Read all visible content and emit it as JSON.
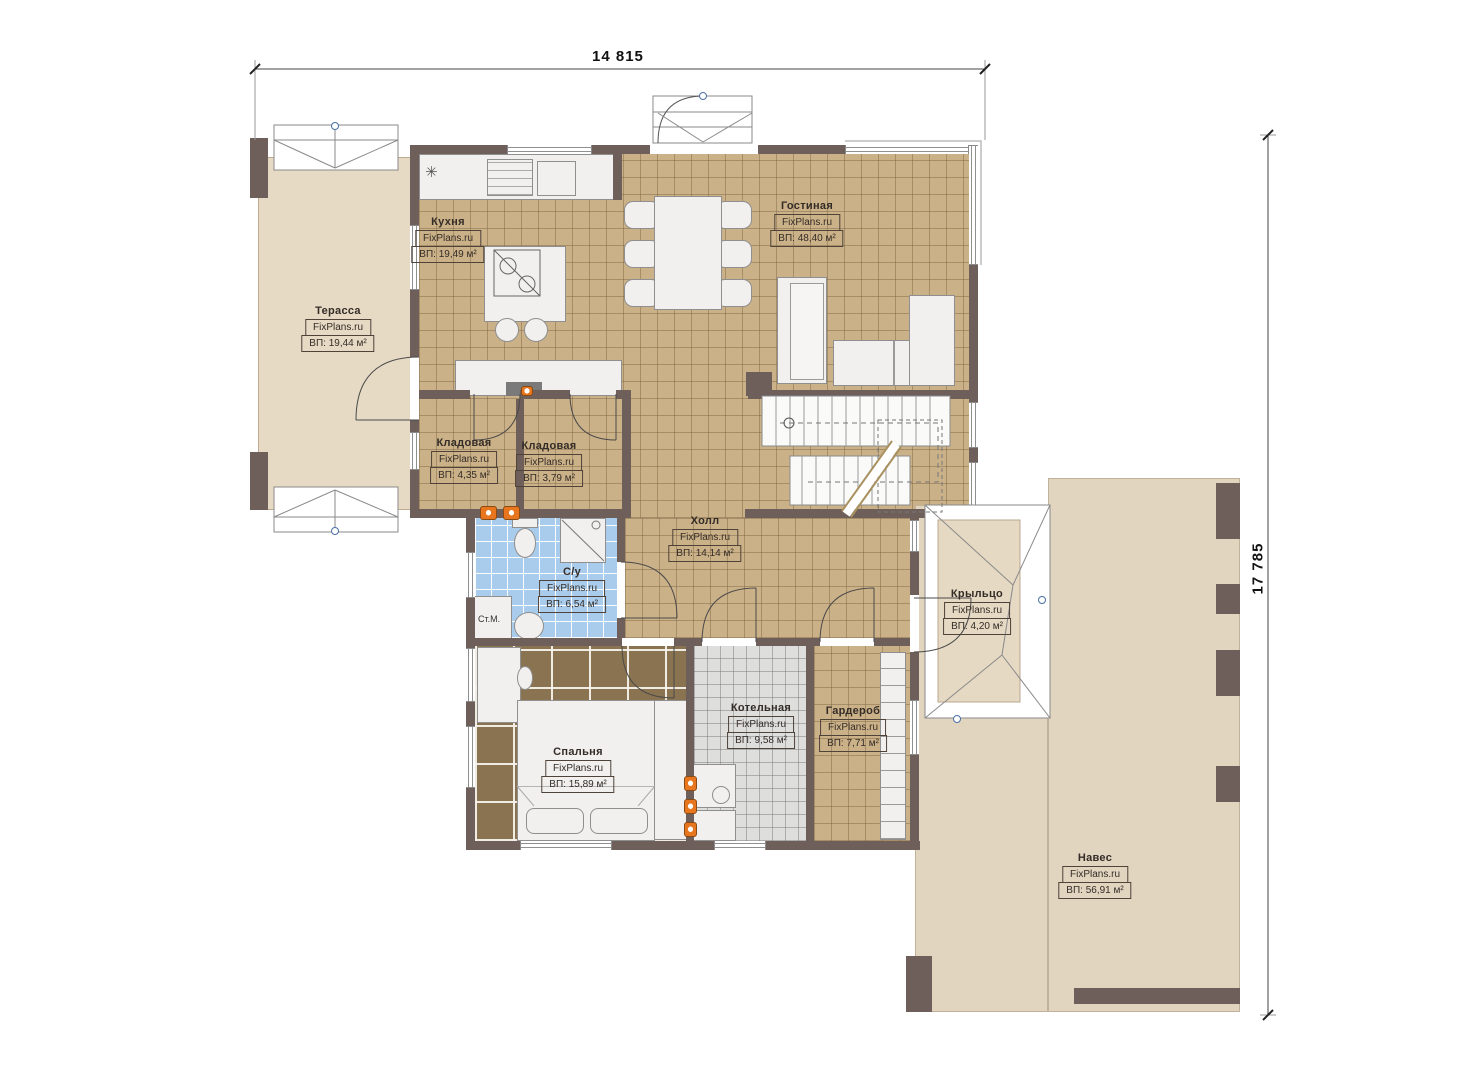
{
  "dimensions": {
    "width_label": "14 815",
    "height_label": "17 785"
  },
  "rooms": [
    {
      "id": "terrace",
      "name": "Терасса",
      "brand": "FixPlans.ru",
      "area": "ВП: 19,44 м²"
    },
    {
      "id": "kitchen",
      "name": "Кухня",
      "brand": "FixPlans.ru",
      "area": "ВП: 19,49 м²"
    },
    {
      "id": "living",
      "name": "Гостиная",
      "brand": "FixPlans.ru",
      "area": "ВП: 48,40 м²"
    },
    {
      "id": "storage-1",
      "name": "Кладовая",
      "brand": "FixPlans.ru",
      "area": "ВП: 4,35 м²"
    },
    {
      "id": "storage-2",
      "name": "Кладовая",
      "brand": "FixPlans.ru",
      "area": "ВП: 3,79 м²"
    },
    {
      "id": "hall",
      "name": "Холл",
      "brand": "FixPlans.ru",
      "area": "ВП: 14,14 м²"
    },
    {
      "id": "bathroom",
      "name": "С/у",
      "brand": "FixPlans.ru",
      "area": "ВП: 6,54 м²"
    },
    {
      "id": "bedroom",
      "name": "Спальня",
      "brand": "FixPlans.ru",
      "area": "ВП: 15,89 м²"
    },
    {
      "id": "boiler",
      "name": "Котельная",
      "brand": "FixPlans.ru",
      "area": "ВП: 9,58 м²"
    },
    {
      "id": "wardrobe",
      "name": "Гардероб",
      "brand": "FixPlans.ru",
      "area": "ВП: 7,71 м²"
    },
    {
      "id": "porch",
      "name": "Крыльцо",
      "brand": "FixPlans.ru",
      "area": "ВП: 4,20 м²"
    },
    {
      "id": "canopy",
      "name": "Навес",
      "brand": "FixPlans.ru",
      "area": "ВП: 56,91 м²"
    }
  ],
  "fixtures": {
    "washing_machine_label": "Ст.М."
  },
  "colors": {
    "wall": "#6f5f5a",
    "tile_tan": "#cbb188",
    "tile_bedroom": "#8a7350",
    "tile_bath": "#a9ccec",
    "tile_boiler": "#dededc",
    "terrace": "#e7dac4",
    "canopy": "#e2d5bf",
    "radiator": "#e8761e"
  }
}
